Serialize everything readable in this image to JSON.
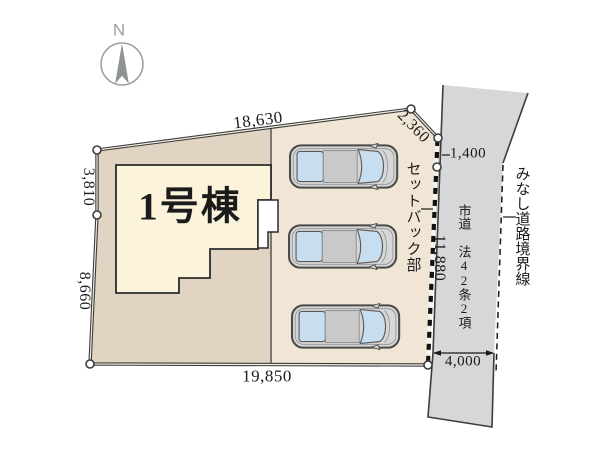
{
  "compass": {
    "north_label": "N"
  },
  "building": {
    "label": "1号棟"
  },
  "dimensions": {
    "top": "18,630",
    "top_right_slant": "2,360",
    "left_upper": "3,810",
    "left_lower": "8,660",
    "bottom": "19,850",
    "right_upper": "1,400",
    "road_frontage": "11,880",
    "road_width": "4,000"
  },
  "annotations": {
    "setback": "セットバック部",
    "road_name": "市道 法42条2項",
    "deemed_road_boundary": "みなし道路境界線"
  },
  "parking": {
    "car_count": 3
  },
  "colors": {
    "yard": "#e1d4c2",
    "parking": "#f1e6d6",
    "building": "#fbf3da",
    "road": "#d7d6d8",
    "porch": "#ffffff",
    "boundary_line": "#3c3c3c",
    "car_body": "#d7d7d7",
    "car_window": "#c7def0"
  }
}
